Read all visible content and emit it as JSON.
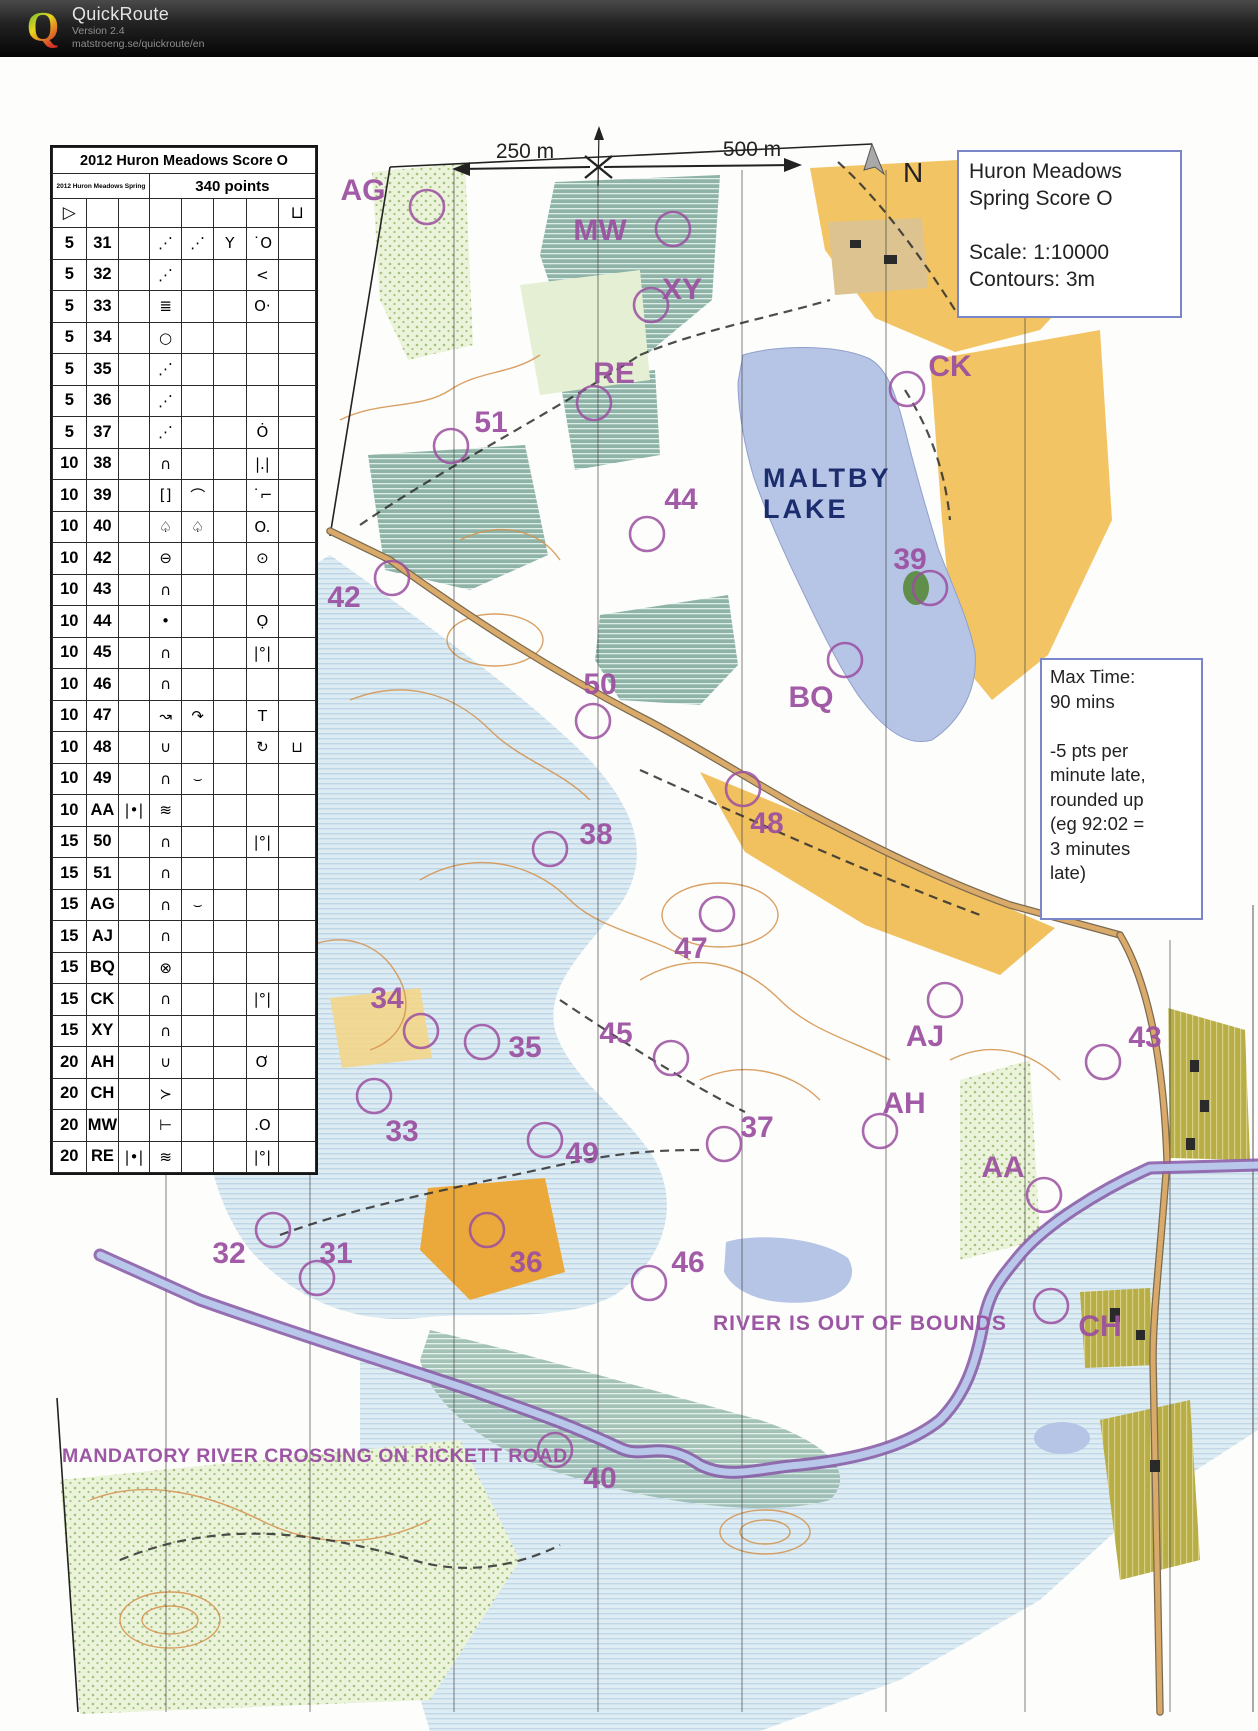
{
  "header": {
    "app_title": "QuickRoute",
    "version": "Version 2.4",
    "url": "matstroeng.se/quickroute/en",
    "logo_letter": "Q"
  },
  "map": {
    "title_box": {
      "line1": "Huron Meadows",
      "line2": "Spring Score O",
      "scale": "Scale:  1:10000",
      "contours": "Contours:  3m"
    },
    "max_time_box": {
      "lines": [
        "Max Time:",
        "90 mins",
        "",
        "-5 pts per",
        "minute late,",
        "rounded up",
        "(eg 92:02 =",
        "3 minutes",
        "late)"
      ]
    },
    "scale_bar": {
      "left_label": "250 m",
      "right_label": "500 m",
      "north_label": "N"
    },
    "lake_label": {
      "line1": "MALTBY",
      "line2": "LAKE"
    },
    "warnings": {
      "river": "RIVER IS OUT OF BOUNDS",
      "crossing": "MANDATORY RIVER CROSSING ON RICKETT ROAD"
    },
    "controls": [
      {
        "code": "AG",
        "x": 427,
        "y": 207,
        "lx": 363,
        "ly": 189
      },
      {
        "code": "MW",
        "x": 673,
        "y": 229,
        "lx": 600,
        "ly": 229
      },
      {
        "code": "XY",
        "x": 651,
        "y": 305,
        "lx": 682,
        "ly": 288
      },
      {
        "code": "RE",
        "x": 594,
        "y": 403,
        "lx": 614,
        "ly": 372
      },
      {
        "code": "CK",
        "x": 907,
        "y": 389,
        "lx": 950,
        "ly": 365
      },
      {
        "code": "51",
        "x": 451,
        "y": 446,
        "lx": 491,
        "ly": 421
      },
      {
        "code": "44",
        "x": 647,
        "y": 534,
        "lx": 681,
        "ly": 498
      },
      {
        "code": "42",
        "x": 392,
        "y": 578,
        "lx": 344,
        "ly": 596
      },
      {
        "code": "39",
        "x": 930,
        "y": 588,
        "lx": 910,
        "ly": 558
      },
      {
        "code": "50",
        "x": 593,
        "y": 721,
        "lx": 600,
        "ly": 683
      },
      {
        "code": "BQ",
        "x": 845,
        "y": 660,
        "lx": 811,
        "ly": 696
      },
      {
        "code": "38",
        "x": 550,
        "y": 849,
        "lx": 596,
        "ly": 833
      },
      {
        "code": "48",
        "x": 743,
        "y": 789,
        "lx": 767,
        "ly": 822
      },
      {
        "code": "47",
        "x": 717,
        "y": 914,
        "lx": 691,
        "ly": 947
      },
      {
        "code": "34",
        "x": 421,
        "y": 1031,
        "lx": 387,
        "ly": 997
      },
      {
        "code": "35",
        "x": 482,
        "y": 1042,
        "lx": 525,
        "ly": 1046
      },
      {
        "code": "45",
        "x": 671,
        "y": 1058,
        "lx": 616,
        "ly": 1032
      },
      {
        "code": "AJ",
        "x": 945,
        "y": 1000,
        "lx": 925,
        "ly": 1035
      },
      {
        "code": "43",
        "x": 1103,
        "y": 1062,
        "lx": 1145,
        "ly": 1036
      },
      {
        "code": "AH",
        "x": 880,
        "y": 1131,
        "lx": 904,
        "ly": 1102
      },
      {
        "code": "33",
        "x": 374,
        "y": 1096,
        "lx": 402,
        "ly": 1130
      },
      {
        "code": "49",
        "x": 545,
        "y": 1140,
        "lx": 582,
        "ly": 1152
      },
      {
        "code": "37",
        "x": 724,
        "y": 1144,
        "lx": 757,
        "ly": 1126
      },
      {
        "code": "AA",
        "x": 1044,
        "y": 1195,
        "lx": 1003,
        "ly": 1166
      },
      {
        "code": "32",
        "x": 273,
        "y": 1230,
        "lx": 229,
        "ly": 1252
      },
      {
        "code": "31",
        "x": 317,
        "y": 1278,
        "lx": 336,
        "ly": 1252
      },
      {
        "code": "36",
        "x": 487,
        "y": 1230,
        "lx": 526,
        "ly": 1261
      },
      {
        "code": "46",
        "x": 649,
        "y": 1283,
        "lx": 688,
        "ly": 1261
      },
      {
        "code": "CH",
        "x": 1051,
        "y": 1306,
        "lx": 1100,
        "ly": 1325
      },
      {
        "code": "40",
        "x": 555,
        "y": 1450,
        "lx": 600,
        "ly": 1477
      }
    ]
  },
  "control_card": {
    "title": "2012 Huron Meadows Score O",
    "event": "2012 Huron Meadows Spring",
    "total": "340 points",
    "start_symbol": "▷",
    "finish_symbol": "⊔",
    "rows": [
      {
        "pts": "5",
        "code": "31",
        "c": "",
        "d": "⋰",
        "e": "⋰",
        "f": "Y",
        "g": "˙O",
        "h": ""
      },
      {
        "pts": "5",
        "code": "32",
        "c": "",
        "d": "⋰",
        "e": "",
        "f": "",
        "g": "<",
        "h": ""
      },
      {
        "pts": "5",
        "code": "33",
        "c": "",
        "d": "≣",
        "e": "",
        "f": "",
        "g": "O·",
        "h": ""
      },
      {
        "pts": "5",
        "code": "34",
        "c": "",
        "d": "○",
        "e": "",
        "f": "",
        "g": "",
        "h": ""
      },
      {
        "pts": "5",
        "code": "35",
        "c": "",
        "d": "⋰",
        "e": "",
        "f": "",
        "g": "",
        "h": ""
      },
      {
        "pts": "5",
        "code": "36",
        "c": "",
        "d": "⋰",
        "e": "",
        "f": "",
        "g": "",
        "h": ""
      },
      {
        "pts": "5",
        "code": "37",
        "c": "",
        "d": "⋰",
        "e": "",
        "f": "",
        "g": "Ȯ",
        "h": ""
      },
      {
        "pts": "10",
        "code": "38",
        "c": "",
        "d": "∩",
        "e": "",
        "f": "",
        "g": "|.|",
        "h": ""
      },
      {
        "pts": "10",
        "code": "39",
        "c": "",
        "d": "[]",
        "e": "⌒",
        "f": "",
        "g": "˙⌐",
        "h": ""
      },
      {
        "pts": "10",
        "code": "40",
        "c": "",
        "d": "♤",
        "e": "♤",
        "f": "",
        "g": "O.",
        "h": ""
      },
      {
        "pts": "10",
        "code": "42",
        "c": "",
        "d": "⊖",
        "e": "",
        "f": "",
        "g": "⊙",
        "h": ""
      },
      {
        "pts": "10",
        "code": "43",
        "c": "",
        "d": "∩",
        "e": "",
        "f": "",
        "g": "",
        "h": ""
      },
      {
        "pts": "10",
        "code": "44",
        "c": "",
        "d": "•",
        "e": "",
        "f": "",
        "g": "Ọ",
        "h": ""
      },
      {
        "pts": "10",
        "code": "45",
        "c": "",
        "d": "∩",
        "e": "",
        "f": "",
        "g": "|°|",
        "h": ""
      },
      {
        "pts": "10",
        "code": "46",
        "c": "",
        "d": "∩",
        "e": "",
        "f": "",
        "g": "",
        "h": ""
      },
      {
        "pts": "10",
        "code": "47",
        "c": "",
        "d": "↝",
        "e": "↷",
        "f": "",
        "g": "T",
        "h": ""
      },
      {
        "pts": "10",
        "code": "48",
        "c": "",
        "d": "∪",
        "e": "",
        "f": "",
        "g": "↻",
        "h": "⊔"
      },
      {
        "pts": "10",
        "code": "49",
        "c": "",
        "d": "∩",
        "e": "⌣",
        "f": "",
        "g": "",
        "h": ""
      },
      {
        "pts": "10",
        "code": "AA",
        "c": "|•|",
        "d": "≋",
        "e": "",
        "f": "",
        "g": "",
        "h": ""
      },
      {
        "pts": "15",
        "code": "50",
        "c": "",
        "d": "∩",
        "e": "",
        "f": "",
        "g": "|°|",
        "h": ""
      },
      {
        "pts": "15",
        "code": "51",
        "c": "",
        "d": "∩",
        "e": "",
        "f": "",
        "g": "",
        "h": ""
      },
      {
        "pts": "15",
        "code": "AG",
        "c": "",
        "d": "∩",
        "e": "⌣",
        "f": "",
        "g": "",
        "h": ""
      },
      {
        "pts": "15",
        "code": "AJ",
        "c": "",
        "d": "∩",
        "e": "",
        "f": "",
        "g": "",
        "h": ""
      },
      {
        "pts": "15",
        "code": "BQ",
        "c": "",
        "d": "⊗",
        "e": "",
        "f": "",
        "g": "",
        "h": ""
      },
      {
        "pts": "15",
        "code": "CK",
        "c": "",
        "d": "∩",
        "e": "",
        "f": "",
        "g": "|°|",
        "h": ""
      },
      {
        "pts": "15",
        "code": "XY",
        "c": "",
        "d": "∩",
        "e": "",
        "f": "",
        "g": "",
        "h": ""
      },
      {
        "pts": "20",
        "code": "AH",
        "c": "",
        "d": "∪",
        "e": "",
        "f": "",
        "g": "Ơ",
        "h": ""
      },
      {
        "pts": "20",
        "code": "CH",
        "c": "",
        "d": "≻",
        "e": "",
        "f": "",
        "g": "",
        "h": ""
      },
      {
        "pts": "20",
        "code": "MW",
        "c": "",
        "d": "⊢",
        "e": "",
        "f": "",
        "g": ".O",
        "h": ""
      },
      {
        "pts": "20",
        "code": "RE",
        "c": "|•|",
        "d": "≋",
        "e": "",
        "f": "",
        "g": "|°|",
        "h": ""
      }
    ]
  },
  "colors": {
    "control_purple": "#9b4fa0",
    "lake_blue": "#b6c4e6",
    "lake_text_navy": "#1c2d6e",
    "open_yellow": "#f3c463",
    "marsh_teal": "#8fb3a6",
    "floodplain_blue": "#d9e9f2",
    "contour_orange": "#d4914b",
    "river_purple": "#8a5fa8",
    "box_border_blue": "#7a86c8"
  }
}
